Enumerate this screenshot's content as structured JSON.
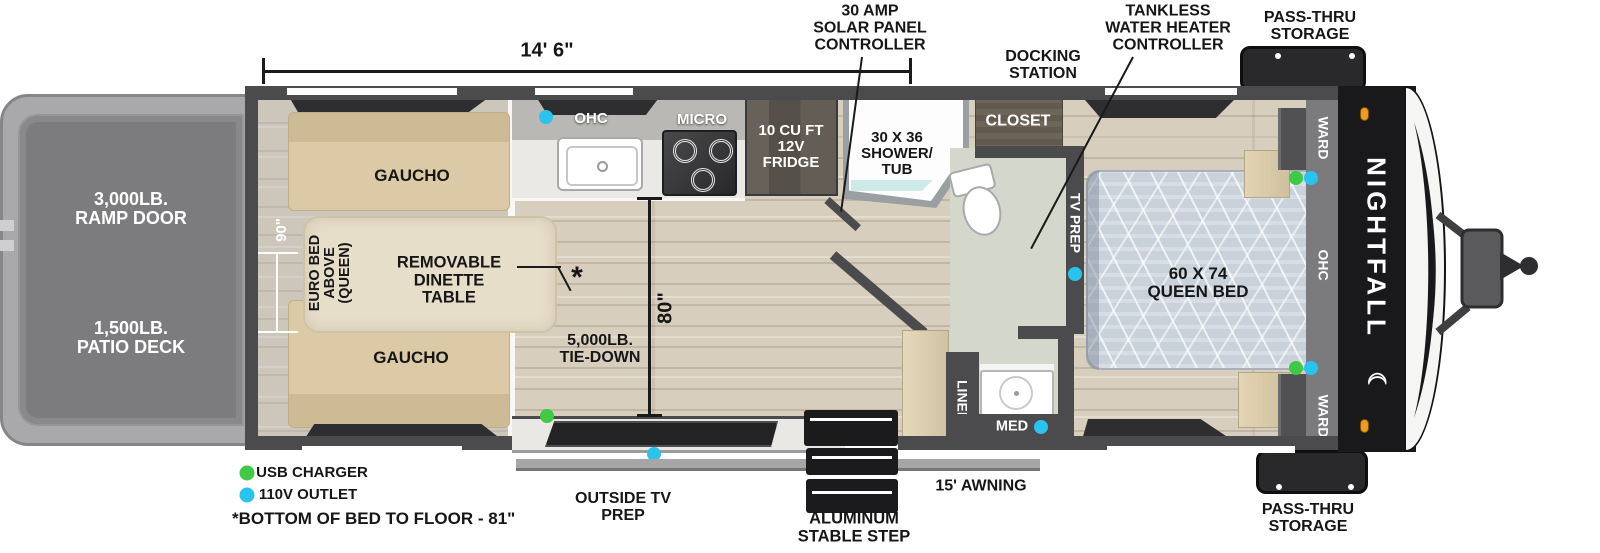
{
  "colors": {
    "accent_green": "#3fc944",
    "accent_blue": "#29c3ee",
    "marker_orange": "#ee9b22",
    "wall_gray": "#4b4b4d"
  },
  "brand": {
    "name": "NIGHTFALL",
    "moon_icon": "☾"
  },
  "dimensions": {
    "length": "14' 6\"",
    "garage_width": "90\"",
    "interior_height": "80\""
  },
  "callouts": {
    "solar": "30 AMP\nSOLAR PANEL\nCONTROLLER",
    "tankless": "TANKLESS\nWATER HEATER\nCONTROLLER",
    "docking": "DOCKING\nSTATION",
    "passthru_top": "PASS-THRU\nSTORAGE",
    "passthru_bottom": "PASS-THRU\nSTORAGE",
    "awning": "15' AWNING",
    "outside_tv": "OUTSIDE TV\nPREP",
    "stable_step": "ALUMINUM\nSTABLE STEP",
    "tie_down": "5,000LB.\nTIE-DOWN",
    "asterisk": "*",
    "footnote": "*BOTTOM OF BED TO FLOOR - 81\""
  },
  "legend": {
    "usb": "USB CHARGER",
    "outlet": "110V OUTLET"
  },
  "exterior": {
    "ramp_door": "3,000LB.\nRAMP DOOR",
    "patio_deck": "1,500LB.\nPATIO DECK"
  },
  "garage": {
    "gaucho_top": "GAUCHO",
    "gaucho_bottom": "GAUCHO",
    "euro_bed": "EURO BED\nABOVE\n(QUEEN)",
    "dinette": "REMOVABLE\nDINETTE\nTABLE"
  },
  "kitchen": {
    "ohc": "OHC",
    "micro": "MICRO",
    "fridge": "10 CU FT\n12V\nFRIDGE"
  },
  "bath": {
    "shower": "30 X 36\nSHOWER/\nTUB",
    "closet": "CLOSET",
    "linen": "LINEN",
    "med": "MED"
  },
  "bedroom": {
    "tv_prep": "TV PREP",
    "queen_bed": "60 X 74\nQUEEN BED",
    "ward_top": "WARD",
    "ward_bottom": "WARD",
    "ohc": "OHC"
  }
}
